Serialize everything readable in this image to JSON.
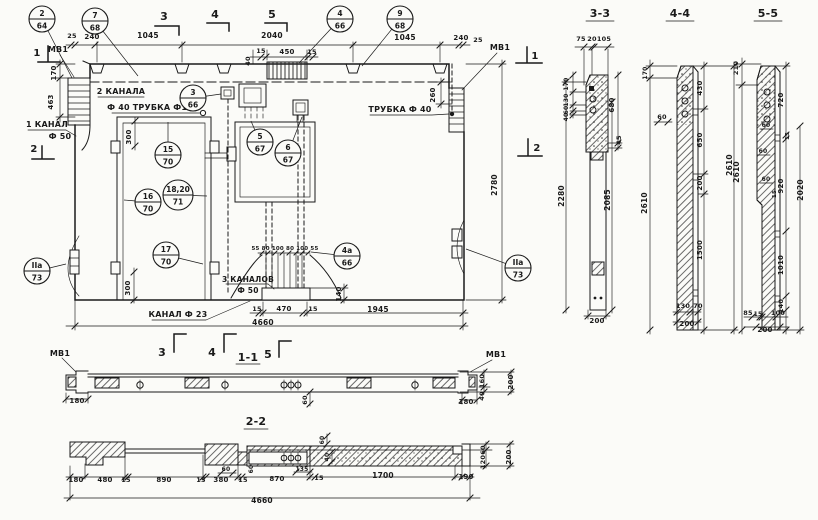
{
  "colors": {
    "ink": "#1a1a1a",
    "paper": "#fbfbf8"
  },
  "drawing": {
    "view_titles": [
      "1-1",
      "2-2",
      "3-3",
      "4-4",
      "5-5"
    ],
    "annotations": [
      {
        "n": "label-mv1-left",
        "t": "МВ1",
        "x": 58,
        "y": 52,
        "s": 8
      },
      {
        "n": "label-mv1-right",
        "t": "МВ1",
        "x": 500,
        "y": 50,
        "s": 8
      },
      {
        "n": "mark-3-top",
        "t": "3",
        "x": 164,
        "y": 20,
        "s": 11
      },
      {
        "n": "mark-4-top",
        "t": "4",
        "x": 215,
        "y": 18,
        "s": 11
      },
      {
        "n": "mark-5-top",
        "t": "5",
        "x": 272,
        "y": 18,
        "s": 11
      },
      {
        "n": "dim-25-top-left",
        "t": "25",
        "x": 72,
        "y": 38,
        "s": 6.5
      },
      {
        "n": "dim-240-top-left",
        "t": "240",
        "x": 92,
        "y": 39,
        "s": 7
      },
      {
        "n": "dim-1045-top-left",
        "t": "1045",
        "x": 148,
        "y": 38,
        "s": 7.5
      },
      {
        "n": "dim-2040-top",
        "t": "2040",
        "x": 272,
        "y": 38,
        "s": 7.5
      },
      {
        "n": "dim-1045-top-right",
        "t": "1045",
        "x": 405,
        "y": 40,
        "s": 7.5
      },
      {
        "n": "dim-240-top-right",
        "t": "240",
        "x": 461,
        "y": 40,
        "s": 7
      },
      {
        "n": "dim-25-top-right",
        "t": "25",
        "x": 478,
        "y": 42,
        "s": 6.5
      },
      {
        "n": "dim-15-grille-left",
        "t": "15",
        "x": 261,
        "y": 53,
        "s": 6.5
      },
      {
        "n": "dim-450-grille",
        "t": "450",
        "x": 287,
        "y": 54,
        "s": 7
      },
      {
        "n": "dim-15-grille-right",
        "t": "15",
        "x": 312,
        "y": 54,
        "s": 6.5
      },
      {
        "n": "dim-40-grille",
        "t": "40",
        "x": 250,
        "y": 61,
        "s": 6.5,
        "r": 1
      },
      {
        "n": "dim-170-left",
        "t": "170",
        "x": 56,
        "y": 73,
        "s": 7,
        "r": 1
      },
      {
        "n": "dim-463-left",
        "t": "463",
        "x": 53,
        "y": 102,
        "s": 7,
        "r": 1
      },
      {
        "n": "label-2-kanala",
        "t": "2 КАНАЛА",
        "x": 121,
        "y": 94,
        "s": 8
      },
      {
        "n": "label-f40-trubka-f15",
        "t": "Ф 40  ТРУБКА Ф15",
        "x": 150,
        "y": 110,
        "s": 8
      },
      {
        "n": "label-1-kanal",
        "t": "1 КАНАЛ",
        "x": 47,
        "y": 127,
        "s": 8
      },
      {
        "n": "label-f50-left",
        "t": "Ф 50",
        "x": 60,
        "y": 139,
        "s": 8
      },
      {
        "n": "mark-1-left",
        "t": "1",
        "x": 37,
        "y": 56,
        "s": 10
      },
      {
        "n": "mark-1-right",
        "t": "1",
        "x": 535,
        "y": 59,
        "s": 10
      },
      {
        "n": "mark-2-left",
        "t": "2",
        "x": 34,
        "y": 152,
        "s": 10
      },
      {
        "n": "mark-2-right",
        "t": "2",
        "x": 537,
        "y": 151,
        "s": 10
      },
      {
        "n": "label-trubka-f40-right",
        "t": "ТРУБКА Ф 40",
        "x": 400,
        "y": 112,
        "s": 8
      },
      {
        "n": "dim-260-right",
        "t": "260",
        "x": 435,
        "y": 95,
        "s": 7,
        "r": 1
      },
      {
        "n": "dim-2780-right",
        "t": "2780",
        "x": 497,
        "y": 185,
        "s": 7.5,
        "r": 1
      },
      {
        "n": "dim-300-door-top",
        "t": "300",
        "x": 131,
        "y": 137,
        "s": 7,
        "r": 1
      },
      {
        "n": "dim-300-door-bottom",
        "t": "300",
        "x": 130,
        "y": 288,
        "s": 7,
        "r": 1
      },
      {
        "n": "dim-55-80-100-row",
        "t": "55 80 100 80 100 55",
        "x": 285,
        "y": 250,
        "s": 5.5
      },
      {
        "n": "label-3-kanalov",
        "t": "3 КАНАЛОВ",
        "x": 248,
        "y": 282,
        "s": 7.5
      },
      {
        "n": "label-f50-bottom",
        "t": "Ф 50",
        "x": 248,
        "y": 293,
        "s": 7.5
      },
      {
        "n": "dim-140-plinth",
        "t": "140",
        "x": 341,
        "y": 294,
        "s": 7,
        "r": 1
      },
      {
        "n": "label-kanal-f23",
        "t": "КАНАЛ Ф 23",
        "x": 178,
        "y": 317,
        "s": 8
      },
      {
        "n": "dim-15-plinth-left",
        "t": "15",
        "x": 257,
        "y": 311,
        "s": 6.5
      },
      {
        "n": "dim-470-plinth",
        "t": "470",
        "x": 284,
        "y": 311,
        "s": 7
      },
      {
        "n": "dim-15-plinth-right",
        "t": "15",
        "x": 313,
        "y": 311,
        "s": 6.5
      },
      {
        "n": "dim-1945-bottom",
        "t": "1945",
        "x": 378,
        "y": 312,
        "s": 7.5
      },
      {
        "n": "dim-4660-main",
        "t": "4660",
        "x": 263,
        "y": 325,
        "s": 7.5
      },
      {
        "n": "mark-3-bottom",
        "t": "3",
        "x": 162,
        "y": 356,
        "s": 11
      },
      {
        "n": "mark-4-bottom",
        "t": "4",
        "x": 212,
        "y": 356,
        "s": 11
      },
      {
        "n": "title-section-1-1",
        "t": "1-1",
        "x": 248,
        "y": 361,
        "s": 11
      },
      {
        "n": "mark-5-bottom",
        "t": "5",
        "x": 268,
        "y": 358,
        "s": 11
      },
      {
        "n": "label-mv1-s11-left",
        "t": "МВ1",
        "x": 60,
        "y": 356,
        "s": 8
      },
      {
        "n": "label-mv1-s11-right",
        "t": "МВ1",
        "x": 496,
        "y": 357,
        "s": 8
      },
      {
        "n": "dim-180-s11-left",
        "t": "180",
        "x": 77,
        "y": 403,
        "s": 7
      },
      {
        "n": "dim-180-s11-right",
        "t": "180",
        "x": 466,
        "y": 404,
        "s": 7
      },
      {
        "n": "dim-60-s11",
        "t": "60",
        "x": 307,
        "y": 400,
        "s": 6.5,
        "r": 1
      },
      {
        "n": "dim-160-s11",
        "t": "160",
        "x": 484,
        "y": 381,
        "s": 6.5,
        "r": 1
      },
      {
        "n": "dim-40-s11",
        "t": "40",
        "x": 484,
        "y": 396,
        "s": 6.5,
        "r": 1
      },
      {
        "n": "dim-200-s11",
        "t": "200",
        "x": 513,
        "y": 382,
        "s": 7,
        "r": 1
      },
      {
        "n": "title-section-2-2",
        "t": "2-2",
        "x": 256,
        "y": 425,
        "s": 11
      },
      {
        "n": "dim-180-s22",
        "t": "180",
        "x": 76,
        "y": 482,
        "s": 7
      },
      {
        "n": "dim-480-s22",
        "t": "480",
        "x": 105,
        "y": 482,
        "s": 7
      },
      {
        "n": "dim-15a-s22",
        "t": "15",
        "x": 126,
        "y": 482,
        "s": 6.5
      },
      {
        "n": "dim-890-s22",
        "t": "890",
        "x": 164,
        "y": 482,
        "s": 7
      },
      {
        "n": "dim-15b-s22",
        "t": "15",
        "x": 201,
        "y": 482,
        "s": 6.5
      },
      {
        "n": "dim-380-s22",
        "t": "380",
        "x": 221,
        "y": 482,
        "s": 7
      },
      {
        "n": "dim-60a-s22",
        "t": "60",
        "x": 226,
        "y": 471,
        "s": 6
      },
      {
        "n": "dim-15c-s22",
        "t": "15",
        "x": 243,
        "y": 482,
        "s": 6.5
      },
      {
        "n": "dim-60b-s22",
        "t": "60",
        "x": 253,
        "y": 469,
        "s": 6,
        "r": 1
      },
      {
        "n": "dim-870-s22",
        "t": "870",
        "x": 277,
        "y": 481,
        "s": 7
      },
      {
        "n": "dim-135-s22",
        "t": "135",
        "x": 302,
        "y": 471,
        "s": 6
      },
      {
        "n": "dim-15d-s22",
        "t": "15",
        "x": 319,
        "y": 480,
        "s": 6.5
      },
      {
        "n": "dim-1700-s22",
        "t": "1700",
        "x": 383,
        "y": 478,
        "s": 7.5
      },
      {
        "n": "dim-190-s22",
        "t": "190",
        "x": 466,
        "y": 479,
        "s": 7
      },
      {
        "n": "dim-40-s22",
        "t": "40",
        "x": 329,
        "y": 457,
        "s": 6,
        "r": 1
      },
      {
        "n": "dim-60c-s22",
        "t": "60",
        "x": 324,
        "y": 440,
        "s": 6,
        "r": 1
      },
      {
        "n": "dim-60d-s22",
        "t": "60",
        "x": 485,
        "y": 450,
        "s": 6.5,
        "r": 1
      },
      {
        "n": "dim-120-s22",
        "t": "120",
        "x": 485,
        "y": 462,
        "s": 6.5,
        "r": 1
      },
      {
        "n": "dim-200-s22",
        "t": "200",
        "x": 511,
        "y": 457,
        "s": 7,
        "r": 1
      },
      {
        "n": "dim-4660-s22",
        "t": "4660",
        "x": 262,
        "y": 503,
        "s": 7.5
      },
      {
        "n": "title-section-3-3",
        "t": "3-3",
        "x": 600,
        "y": 17,
        "s": 11
      },
      {
        "n": "dim-75-s33",
        "t": "75",
        "x": 581,
        "y": 41,
        "s": 6.5
      },
      {
        "n": "dim-20-s33",
        "t": "20",
        "x": 592,
        "y": 41,
        "s": 6.5
      },
      {
        "n": "dim-105-s33",
        "t": "105",
        "x": 604,
        "y": 41,
        "s": 6.5
      },
      {
        "n": "dim-170-s33",
        "t": "170",
        "x": 568,
        "y": 84,
        "s": 6,
        "r": 1
      },
      {
        "n": "dim-130-s33",
        "t": "130",
        "x": 568,
        "y": 100,
        "s": 6,
        "r": 1
      },
      {
        "n": "dim-60-s33",
        "t": "60",
        "x": 568,
        "y": 110,
        "s": 6,
        "r": 1
      },
      {
        "n": "dim-40-s33",
        "t": "40",
        "x": 568,
        "y": 117,
        "s": 6,
        "r": 1
      },
      {
        "n": "dim-680-s33",
        "t": "680",
        "x": 614,
        "y": 105,
        "s": 7,
        "r": 1
      },
      {
        "n": "dim-45-s33",
        "t": "45",
        "x": 621,
        "y": 140,
        "s": 6.5,
        "r": 1
      },
      {
        "n": "dim-2280-s33",
        "t": "2280",
        "x": 564,
        "y": 196,
        "s": 7.5,
        "r": 1
      },
      {
        "n": "dim-2085-s33",
        "t": "2085",
        "x": 610,
        "y": 200,
        "s": 7.5,
        "r": 1
      },
      {
        "n": "dim-200-s33",
        "t": "200",
        "x": 597,
        "y": 323,
        "s": 7
      },
      {
        "n": "title-section-4-4",
        "t": "4-4",
        "x": 680,
        "y": 17,
        "s": 11
      },
      {
        "n": "dim-170-s44",
        "t": "170",
        "x": 647,
        "y": 73,
        "s": 6,
        "r": 1
      },
      {
        "n": "dim-60-s44",
        "t": "60",
        "x": 662,
        "y": 119,
        "s": 6.5
      },
      {
        "n": "dim-2610-s44-left",
        "t": "2610",
        "x": 647,
        "y": 203,
        "s": 7.5,
        "r": 1
      },
      {
        "n": "dim-430-s44",
        "t": "430",
        "x": 702,
        "y": 88,
        "s": 7,
        "r": 1
      },
      {
        "n": "dim-650-s44",
        "t": "650",
        "x": 702,
        "y": 140,
        "s": 7,
        "r": 1
      },
      {
        "n": "dim-200-s44",
        "t": "200",
        "x": 702,
        "y": 183,
        "s": 7,
        "r": 1
      },
      {
        "n": "dim-1500-s44",
        "t": "1500",
        "x": 702,
        "y": 250,
        "s": 7,
        "r": 1
      },
      {
        "n": "dim-2610-s44-right",
        "t": "2610",
        "x": 732,
        "y": 165,
        "s": 7.5,
        "r": 1
      },
      {
        "n": "dim-130-s44",
        "t": "130",
        "x": 683,
        "y": 308,
        "s": 6.5
      },
      {
        "n": "dim-70-s44",
        "t": "70",
        "x": 698,
        "y": 308,
        "s": 6.5
      },
      {
        "n": "dim-200-s44",
        "t": "200",
        "x": 687,
        "y": 326,
        "s": 7
      },
      {
        "n": "title-section-5-5",
        "t": "5-5",
        "x": 768,
        "y": 17,
        "s": 11
      },
      {
        "n": "dim-210-s55",
        "t": "210",
        "x": 738,
        "y": 68,
        "s": 6.5,
        "r": 1
      },
      {
        "n": "dim-720-s55",
        "t": "720",
        "x": 783,
        "y": 100,
        "s": 7,
        "r": 1
      },
      {
        "n": "dim-60a-s55",
        "t": "60",
        "x": 766,
        "y": 127,
        "s": 6
      },
      {
        "n": "dim-15a-s55",
        "t": "15",
        "x": 789,
        "y": 136,
        "s": 5.5,
        "r": 1
      },
      {
        "n": "dim-60b-s55",
        "t": "60",
        "x": 763,
        "y": 153,
        "s": 6
      },
      {
        "n": "dim-920-s55",
        "t": "920",
        "x": 783,
        "y": 186,
        "s": 7,
        "r": 1
      },
      {
        "n": "dim-60c-s55",
        "t": "60",
        "x": 766,
        "y": 181,
        "s": 6
      },
      {
        "n": "dim-15b-s55",
        "t": "15",
        "x": 776,
        "y": 194,
        "s": 5.5,
        "r": 1
      },
      {
        "n": "dim-1010-s55",
        "t": "1010",
        "x": 783,
        "y": 265,
        "s": 7,
        "r": 1
      },
      {
        "n": "dim-140-s55",
        "t": "140",
        "x": 783,
        "y": 306,
        "s": 6.5,
        "r": 1
      },
      {
        "n": "dim-2610-s55",
        "t": "2610",
        "x": 739,
        "y": 172,
        "s": 7.5,
        "r": 1
      },
      {
        "n": "dim-2020-s55",
        "t": "2020",
        "x": 803,
        "y": 190,
        "s": 7.5,
        "r": 1
      },
      {
        "n": "dim-85-s55",
        "t": "85",
        "x": 748,
        "y": 315,
        "s": 6.5
      },
      {
        "n": "dim-15c-s55",
        "t": "15",
        "x": 758,
        "y": 316,
        "s": 6
      },
      {
        "n": "dim-100-s55",
        "t": "100",
        "x": 778,
        "y": 315,
        "s": 6.5
      },
      {
        "n": "dim-200-s55",
        "t": "200",
        "x": 765,
        "y": 332,
        "s": 7
      }
    ],
    "callouts": [
      {
        "n": "callout-2-64",
        "top": "2",
        "bot": "64",
        "x": 42,
        "y": 19,
        "lx": 72,
        "ly": 78
      },
      {
        "n": "callout-7-68",
        "top": "7",
        "bot": "68",
        "x": 95,
        "y": 21,
        "lx": 138,
        "ly": 76
      },
      {
        "n": "callout-3-66",
        "top": "3",
        "bot": "66",
        "x": 193,
        "y": 98,
        "lx": 221,
        "ly": 94
      },
      {
        "n": "callout-4-66",
        "top": "4",
        "bot": "66",
        "x": 340,
        "y": 19,
        "lx": 299,
        "ly": 63
      },
      {
        "n": "callout-9-68",
        "top": "9",
        "bot": "68",
        "x": 400,
        "y": 19,
        "lx": 362,
        "ly": 66
      },
      {
        "n": "callout-15-70",
        "top": "15",
        "bot": "70",
        "x": 168,
        "y": 155,
        "lx": 168,
        "ly": 122
      },
      {
        "n": "callout-18-20-71",
        "top": "18,20",
        "bot": "71",
        "x": 178,
        "y": 195,
        "lx": 207,
        "ly": 196,
        "rr": 15
      },
      {
        "n": "callout-16-70",
        "top": "16",
        "bot": "70",
        "x": 148,
        "y": 202,
        "lx": 124,
        "ly": 200
      },
      {
        "n": "callout-17-70",
        "top": "17",
        "bot": "70",
        "x": 166,
        "y": 255,
        "lx": 203,
        "ly": 264
      },
      {
        "n": "callout-5-67",
        "top": "5",
        "bot": "67",
        "x": 260,
        "y": 142,
        "lx": 251,
        "ly": 121
      },
      {
        "n": "callout-6-67",
        "top": "6",
        "bot": "67",
        "x": 288,
        "y": 153,
        "lx": 302,
        "ly": 117
      },
      {
        "n": "callout-4a-66",
        "top": "4а",
        "bot": "66",
        "x": 347,
        "y": 256,
        "lx": 311,
        "ly": 252
      },
      {
        "n": "callout-2a-73-left",
        "top": "IIа",
        "bot": "73",
        "x": 37,
        "y": 271,
        "lx": 66,
        "ly": 264
      },
      {
        "n": "callout-2a-73-right",
        "top": "IIа",
        "bot": "73",
        "x": 518,
        "y": 268,
        "lx": 466,
        "ly": 249
      }
    ]
  }
}
